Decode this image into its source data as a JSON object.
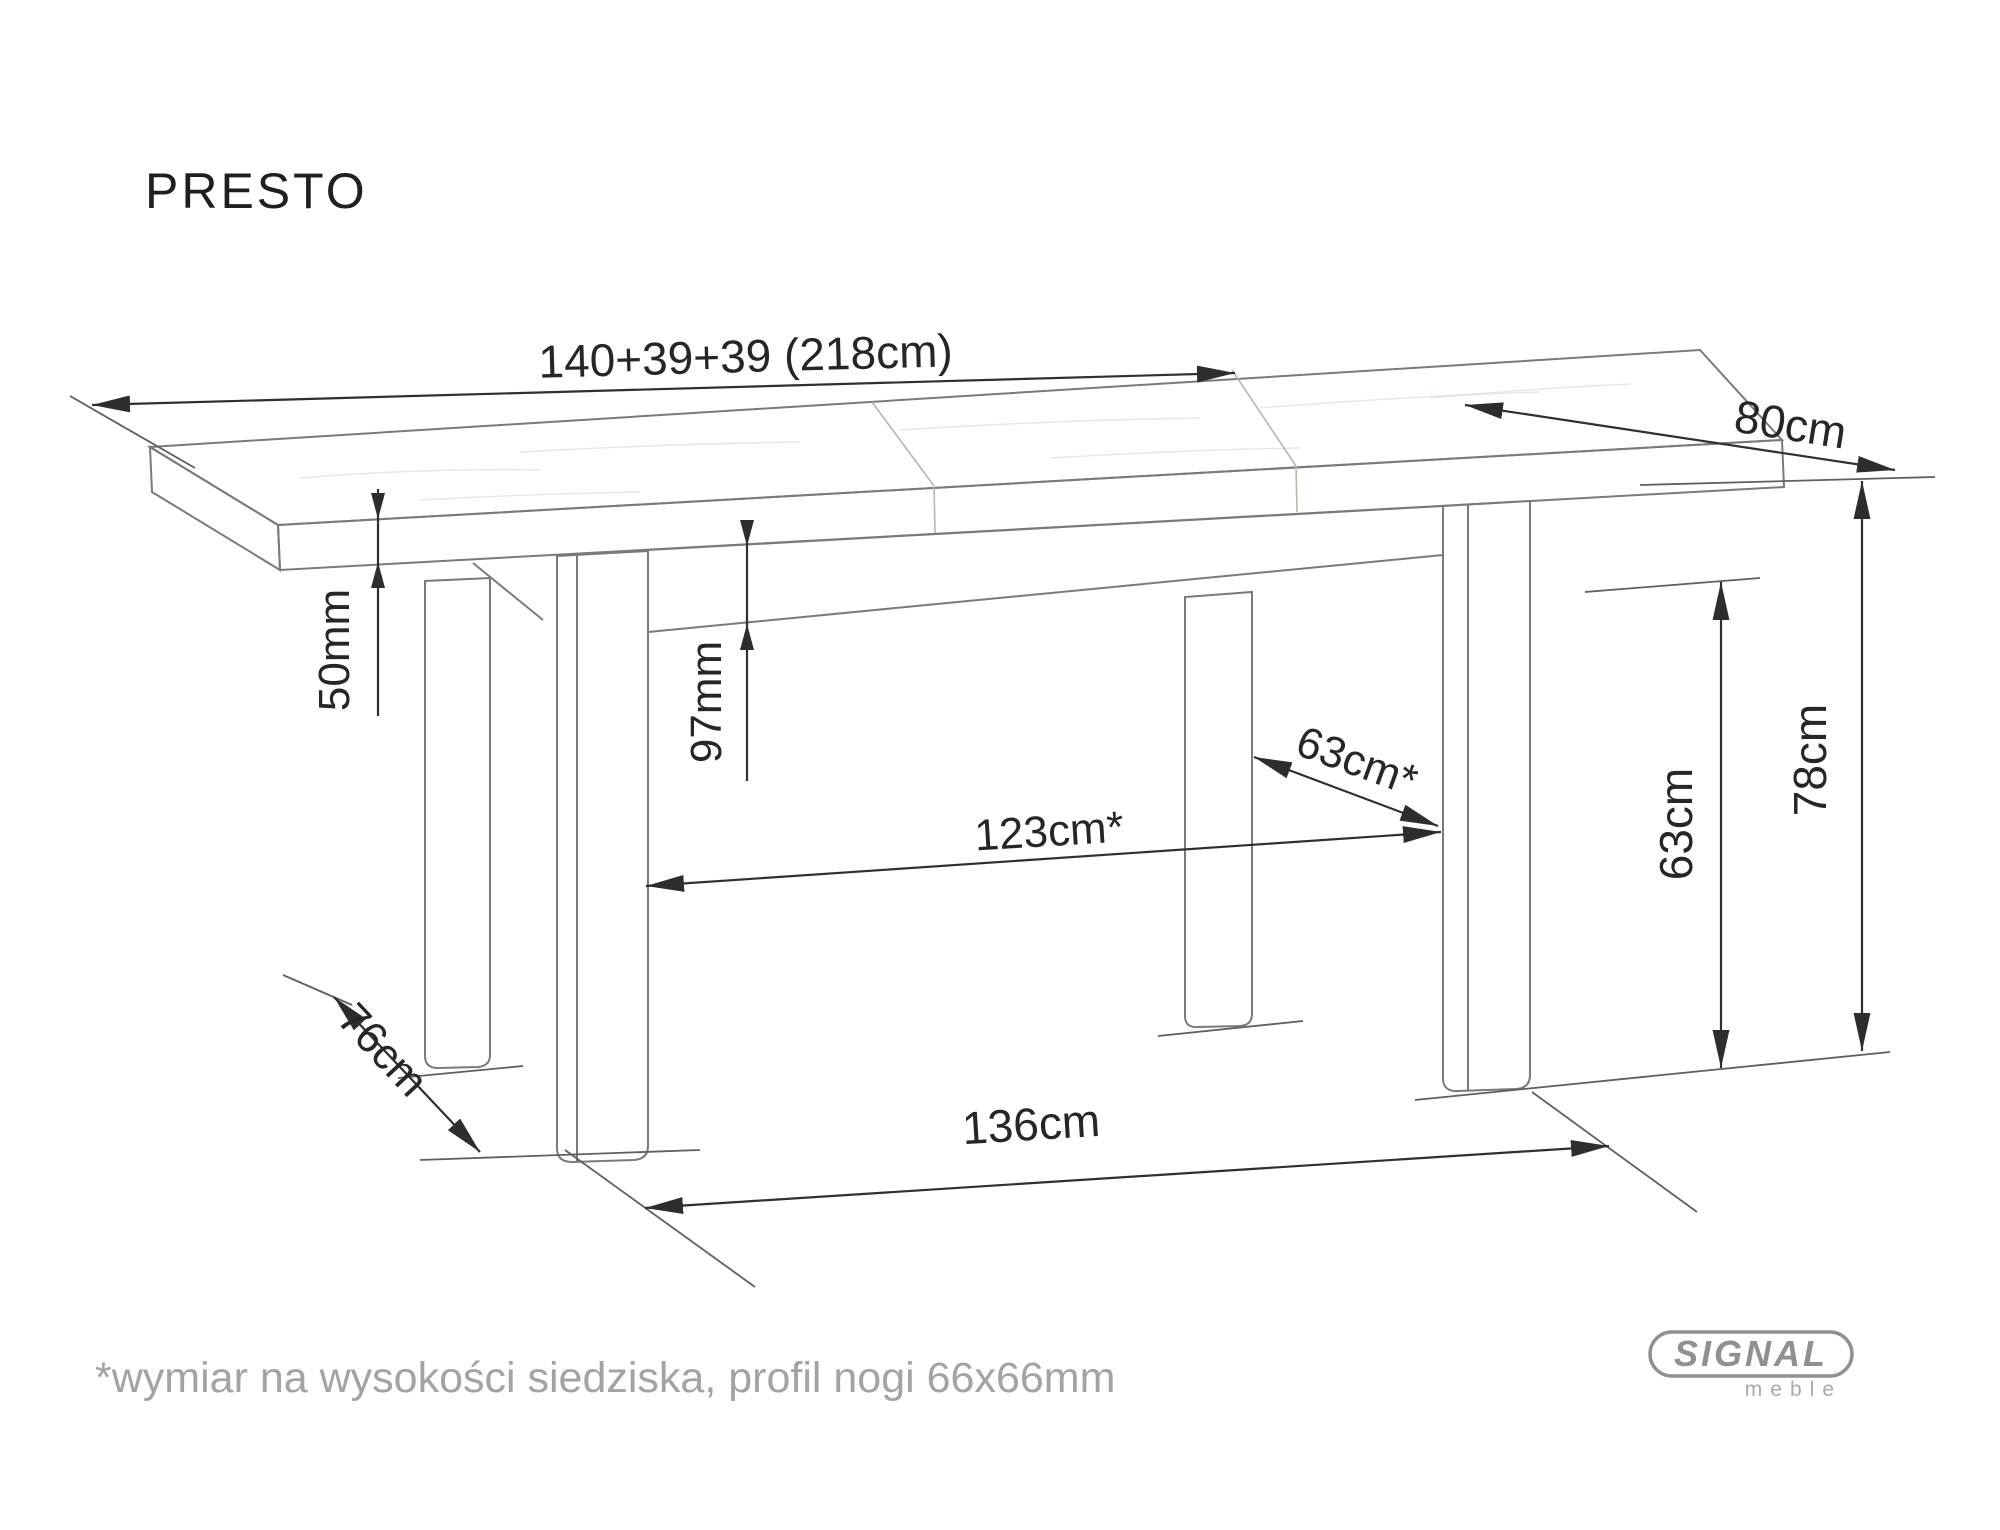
{
  "title": "PRESTO",
  "dimensions": {
    "total_length": "140+39+39 (218cm)",
    "depth": "80cm",
    "top_thickness": "50mm",
    "apron_height": "97mm",
    "inner_length": "123cm*",
    "inner_depth": "63cm*",
    "apron_to_floor": "63cm",
    "height": "78cm",
    "leg_spacing_depth": "76cm",
    "leg_spacing_length": "136cm"
  },
  "footnote": "*wymiar na wysokości siedziska, profil nogi 66x66mm",
  "logo": {
    "brand": "SIGNAL",
    "subtitle": "meble"
  },
  "colors": {
    "drawing_outline": "#7a7a7a",
    "dimension_line": "#2f2f2f",
    "label_text": "#262626",
    "footnote_text": "#a3a3a3",
    "logo_gray": "#8f9093",
    "background": "#ffffff"
  }
}
